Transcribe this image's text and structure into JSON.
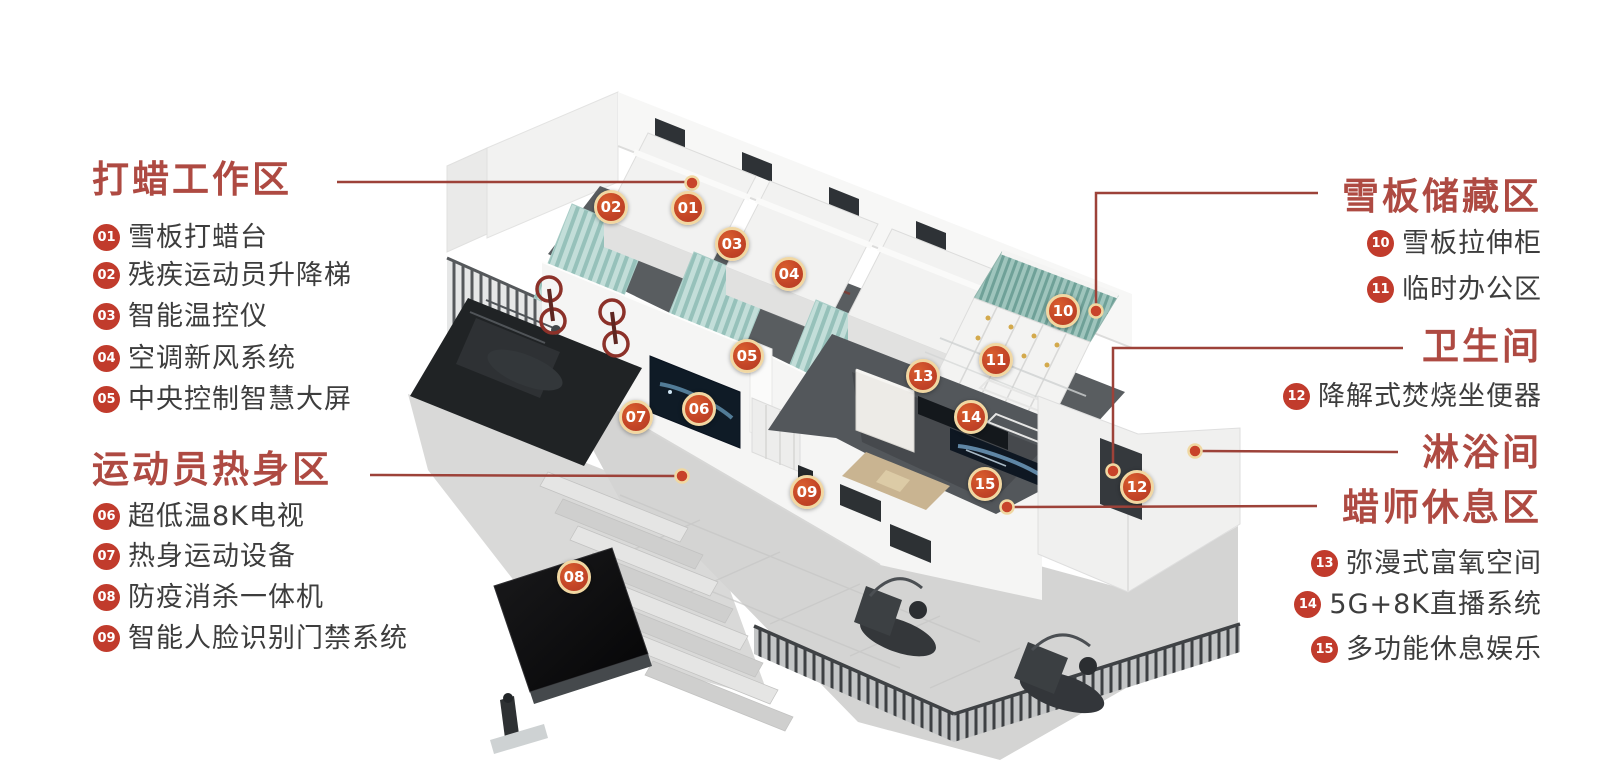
{
  "colors": {
    "heading_red": "#ae4a42",
    "leader_line": "#9d4239",
    "list_badge": "#c13b2c",
    "marker_fill": "#c44527",
    "marker_ring": "#f1d7a2",
    "label_text": "#3d3d3d"
  },
  "panels": {
    "left": {
      "sections": [
        {
          "title": "打蜡工作区",
          "items": [
            {
              "num": "01",
              "label": "雪板打蜡台"
            },
            {
              "num": "02",
              "label": "残疾运动员升降梯"
            },
            {
              "num": "03",
              "label": "智能温控仪"
            },
            {
              "num": "04",
              "label": "空调新风系统"
            },
            {
              "num": "05",
              "label": "中央控制智慧大屏"
            }
          ]
        },
        {
          "title": "运动员热身区",
          "items": [
            {
              "num": "06",
              "label": "超低温8K电视"
            },
            {
              "num": "07",
              "label": "热身运动设备"
            },
            {
              "num": "08",
              "label": "防疫消杀一体机"
            },
            {
              "num": "09",
              "label": "智能人脸识别门禁系统"
            }
          ]
        }
      ]
    },
    "right": {
      "sections": [
        {
          "title": "雪板储藏区",
          "items": [
            {
              "num": "10",
              "label": "雪板拉伸柜"
            },
            {
              "num": "11",
              "label": "临时办公区"
            }
          ]
        },
        {
          "title": "卫生间",
          "items": [
            {
              "num": "12",
              "label": "降解式焚烧坐便器"
            }
          ]
        },
        {
          "title": "淋浴间",
          "items": []
        },
        {
          "title": "蜡师休息区",
          "items": [
            {
              "num": "13",
              "label": "弥漫式富氧空间"
            },
            {
              "num": "14",
              "label": "5G+8K直播系统"
            },
            {
              "num": "15",
              "label": "多功能休息娱乐"
            }
          ]
        }
      ]
    }
  },
  "markers": [
    {
      "num": "01"
    },
    {
      "num": "02"
    },
    {
      "num": "03"
    },
    {
      "num": "04"
    },
    {
      "num": "05"
    },
    {
      "num": "06"
    },
    {
      "num": "07"
    },
    {
      "num": "08"
    },
    {
      "num": "09"
    },
    {
      "num": "10"
    },
    {
      "num": "11"
    },
    {
      "num": "12"
    },
    {
      "num": "13"
    },
    {
      "num": "14"
    },
    {
      "num": "15"
    }
  ]
}
